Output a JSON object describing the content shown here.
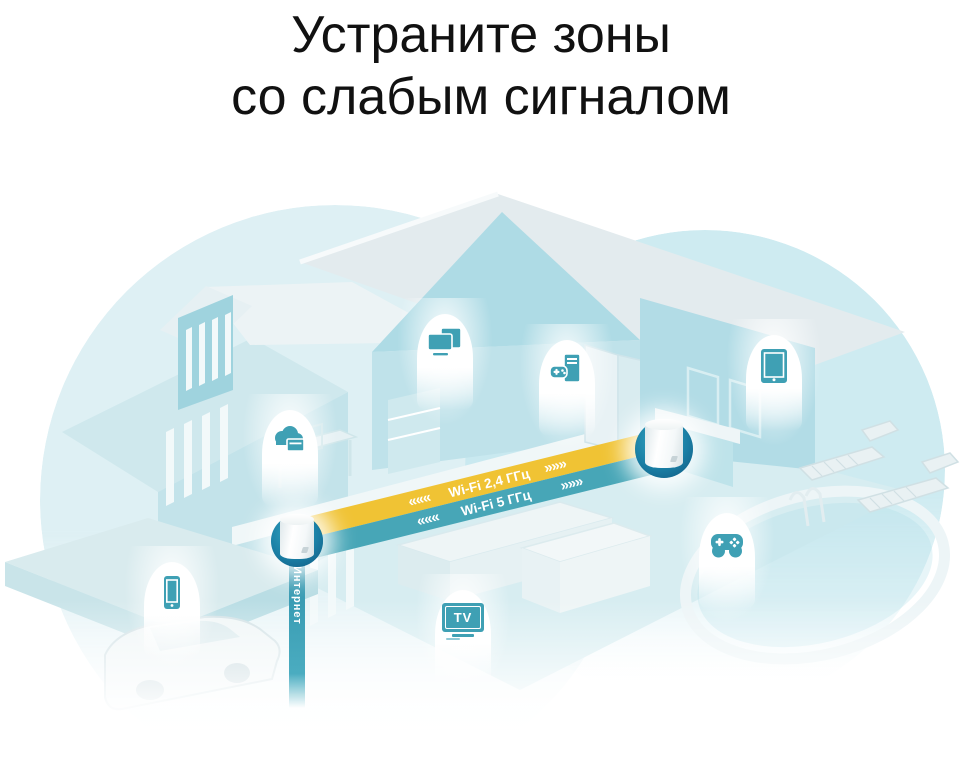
{
  "title": {
    "line1": "Устраните зоны",
    "line2": "со слабым сигналом"
  },
  "connection": {
    "wifi24_label": "Wi-Fi 2,4 ГГц",
    "wifi5_label": "Wi-Fi 5 ГГц",
    "arrows_left": "«««",
    "arrows_right": "»»»",
    "internet_label": "Интернет"
  },
  "icons": {
    "tv_label": "TV",
    "device_icons": [
      "computer-monitor-icon",
      "cloud-storage-icon",
      "gaming-pc-icon",
      "tablet-icon",
      "gamepad-icon",
      "tv-icon",
      "smartphone-icon"
    ],
    "unit_icon": "mesh-router-cylinder"
  },
  "colors": {
    "band_yellow": "#F0C334",
    "band_teal": "#47A6B7",
    "device_icon_teal": "#3FA0B4",
    "unit_ring_teal": "#11577F",
    "coverage_left": "#D5ECF1",
    "coverage_right": "#C5E7EE",
    "title_text": "#111111"
  }
}
